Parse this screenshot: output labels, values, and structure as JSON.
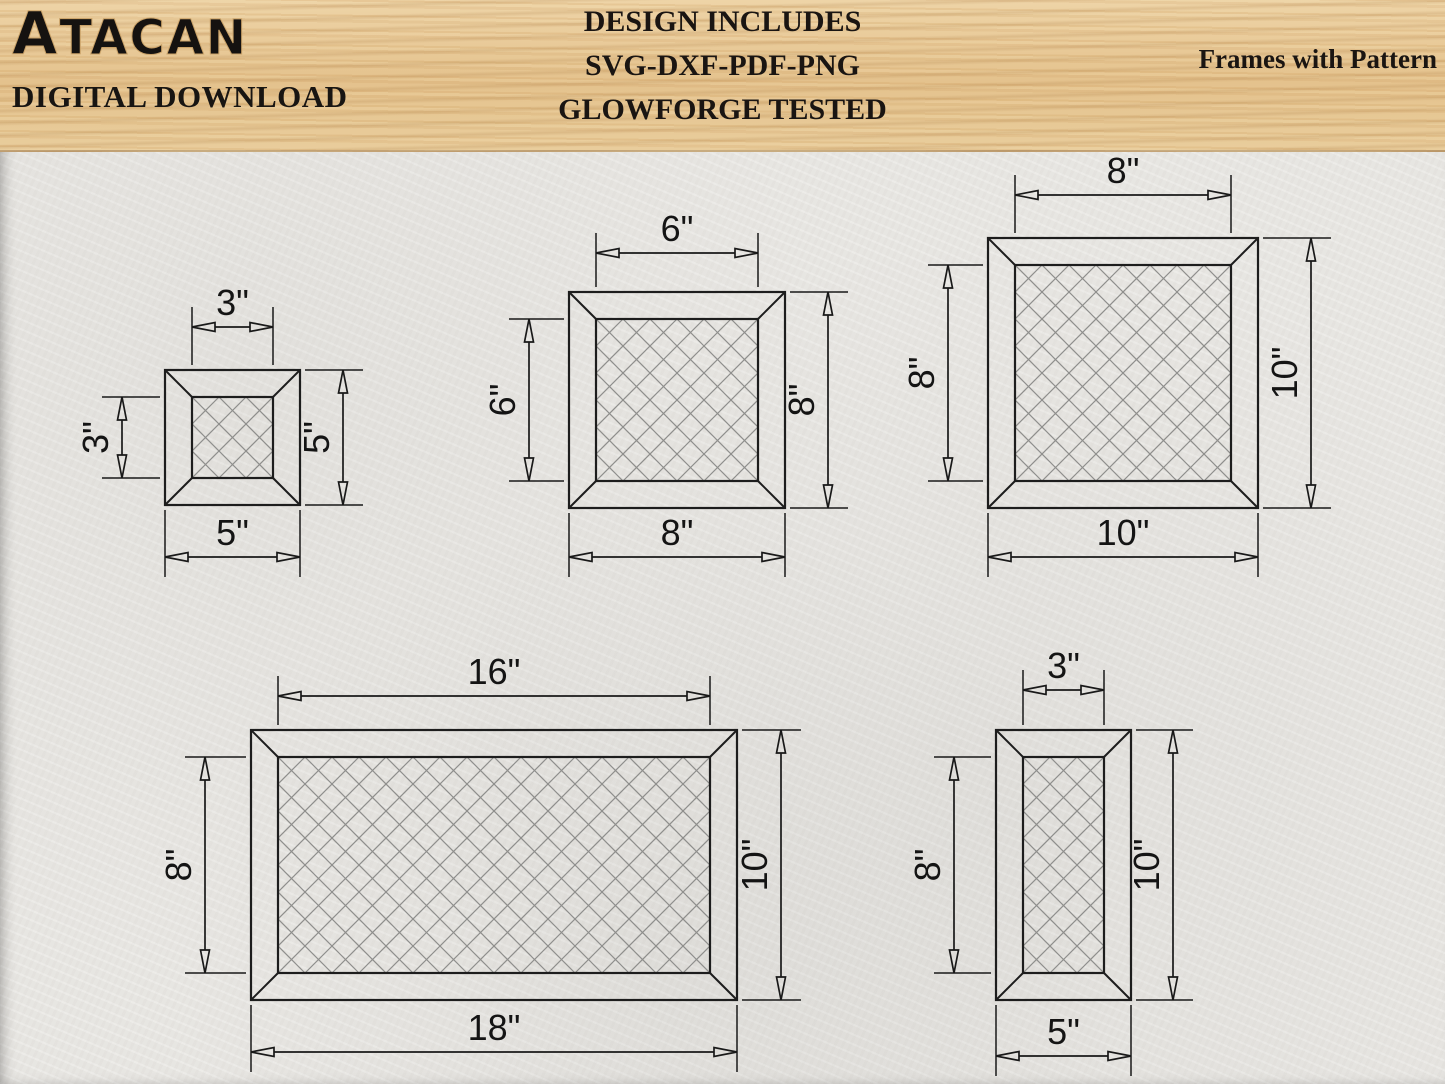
{
  "header": {
    "logo": "ATACAN",
    "subtitle": "DIGITAL DOWNLOAD",
    "center_lines": [
      "DESIGN INCLUDES",
      "SVG-DXF-PDF-PNG",
      "GLOWFORGE TESTED"
    ],
    "right_title": "Frames with Pattern"
  },
  "colors": {
    "ink": "#191919",
    "pattern_line": "#8e8e8c",
    "paper": "#e9e7e3",
    "wood": "#e4c28d"
  },
  "drawing": {
    "scale_px_per_inch": 27,
    "pattern_period_in": 1,
    "arrow_len": 23,
    "arrow_halfwidth": 4.5,
    "frames": [
      {
        "name": "frame-square-5in",
        "pos": [
          165,
          370
        ],
        "outer_in": [
          5,
          5
        ],
        "inner_in": [
          3,
          3
        ],
        "dims": {
          "top": {
            "label": "3\"",
            "span": "inner",
            "offset": 43
          },
          "left": {
            "label": "3\"",
            "span": "inner",
            "offset": 43
          },
          "right": {
            "label": "5\"",
            "span": "outer",
            "offset": 43
          },
          "bottom": {
            "label": "5\"",
            "span": "outer",
            "offset": 52
          }
        }
      },
      {
        "name": "frame-square-8in",
        "pos": [
          569,
          292
        ],
        "outer_in": [
          8,
          8
        ],
        "inner_in": [
          6,
          6
        ],
        "dims": {
          "top": {
            "label": "6\"",
            "span": "inner",
            "offset": 39
          },
          "left": {
            "label": "6\"",
            "span": "inner",
            "offset": 40
          },
          "right": {
            "label": "8\"",
            "span": "outer",
            "offset": 43
          },
          "bottom": {
            "label": "8\"",
            "span": "outer",
            "offset": 49
          }
        }
      },
      {
        "name": "frame-square-10in",
        "pos": [
          988,
          238
        ],
        "outer_in": [
          10,
          10
        ],
        "inner_in": [
          8,
          8
        ],
        "dims": {
          "top": {
            "label": "8\"",
            "span": "inner",
            "offset": 43
          },
          "left": {
            "label": "8\"",
            "span": "inner",
            "offset": 40
          },
          "right": {
            "label": "10\"",
            "span": "outer",
            "offset": 53
          },
          "bottom": {
            "label": "10\"",
            "span": "outer",
            "offset": 49
          }
        }
      },
      {
        "name": "frame-rect-18x10in",
        "pos": [
          251,
          730
        ],
        "outer_in": [
          18,
          10
        ],
        "inner_in": [
          16,
          8
        ],
        "dims": {
          "top": {
            "label": "16\"",
            "span": "inner",
            "offset": 34
          },
          "left": {
            "label": "8\"",
            "span": "inner",
            "offset": 46
          },
          "right": {
            "label": "10\"",
            "span": "outer",
            "offset": 44
          },
          "bottom": {
            "label": "18\"",
            "span": "outer",
            "offset": 52
          }
        }
      },
      {
        "name": "frame-rect-5x10in",
        "pos": [
          996,
          730
        ],
        "outer_in": [
          5,
          10
        ],
        "inner_in": [
          3,
          8
        ],
        "dims": {
          "top": {
            "label": "3\"",
            "span": "inner",
            "offset": 40
          },
          "left": {
            "label": "8\"",
            "span": "inner",
            "offset": 42
          },
          "right": {
            "label": "10\"",
            "span": "outer",
            "offset": 42
          },
          "bottom": {
            "label": "5\"",
            "span": "outer",
            "offset": 56
          }
        }
      }
    ]
  }
}
